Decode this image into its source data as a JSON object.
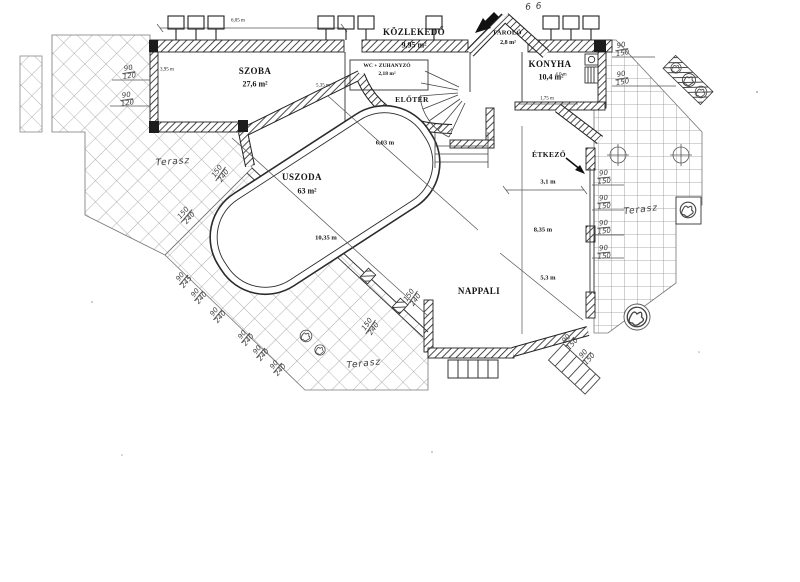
{
  "plan": {
    "rooms": {
      "szoba": {
        "name": "SZOBA",
        "area": "27,6 m²"
      },
      "kozlekedo": {
        "name": "KÖZLEKEDŐ",
        "area": "9,95 m²"
      },
      "tarolo": {
        "name": "TÁROLÓ",
        "area": "2,8 m²"
      },
      "wc_zuhanyzo": {
        "name": "WC + ZUHANYZÓ",
        "area": "2,18 m²"
      },
      "eloter": {
        "name": "ELŐTÉR"
      },
      "konyha": {
        "name": "KONYHA",
        "area": "10,4 m²"
      },
      "uszoda": {
        "name": "USZODA",
        "area": "63 m²"
      },
      "etkezo": {
        "name": "ÉTKEZŐ"
      },
      "nappali": {
        "name": "NAPPALI"
      }
    },
    "dimensions": {
      "szoba_width": "6,05 m",
      "szoba_left": "3,95 m",
      "szoba_height": "5,35 m",
      "pool_width": "6,03 m",
      "pool_length": "10,35 m",
      "konyha_bottom": "1,75 m",
      "konyha_side": "4,0 m",
      "etkezo_width": "3,1 m",
      "nappali_length": "8,35 m",
      "nappali_width": "5,3 m"
    },
    "handwritten": {
      "terasz": "Terasz",
      "w90": "90",
      "w120": "120",
      "w150": "150",
      "w240": "240",
      "w245": "245",
      "top_note": "6 6"
    }
  }
}
